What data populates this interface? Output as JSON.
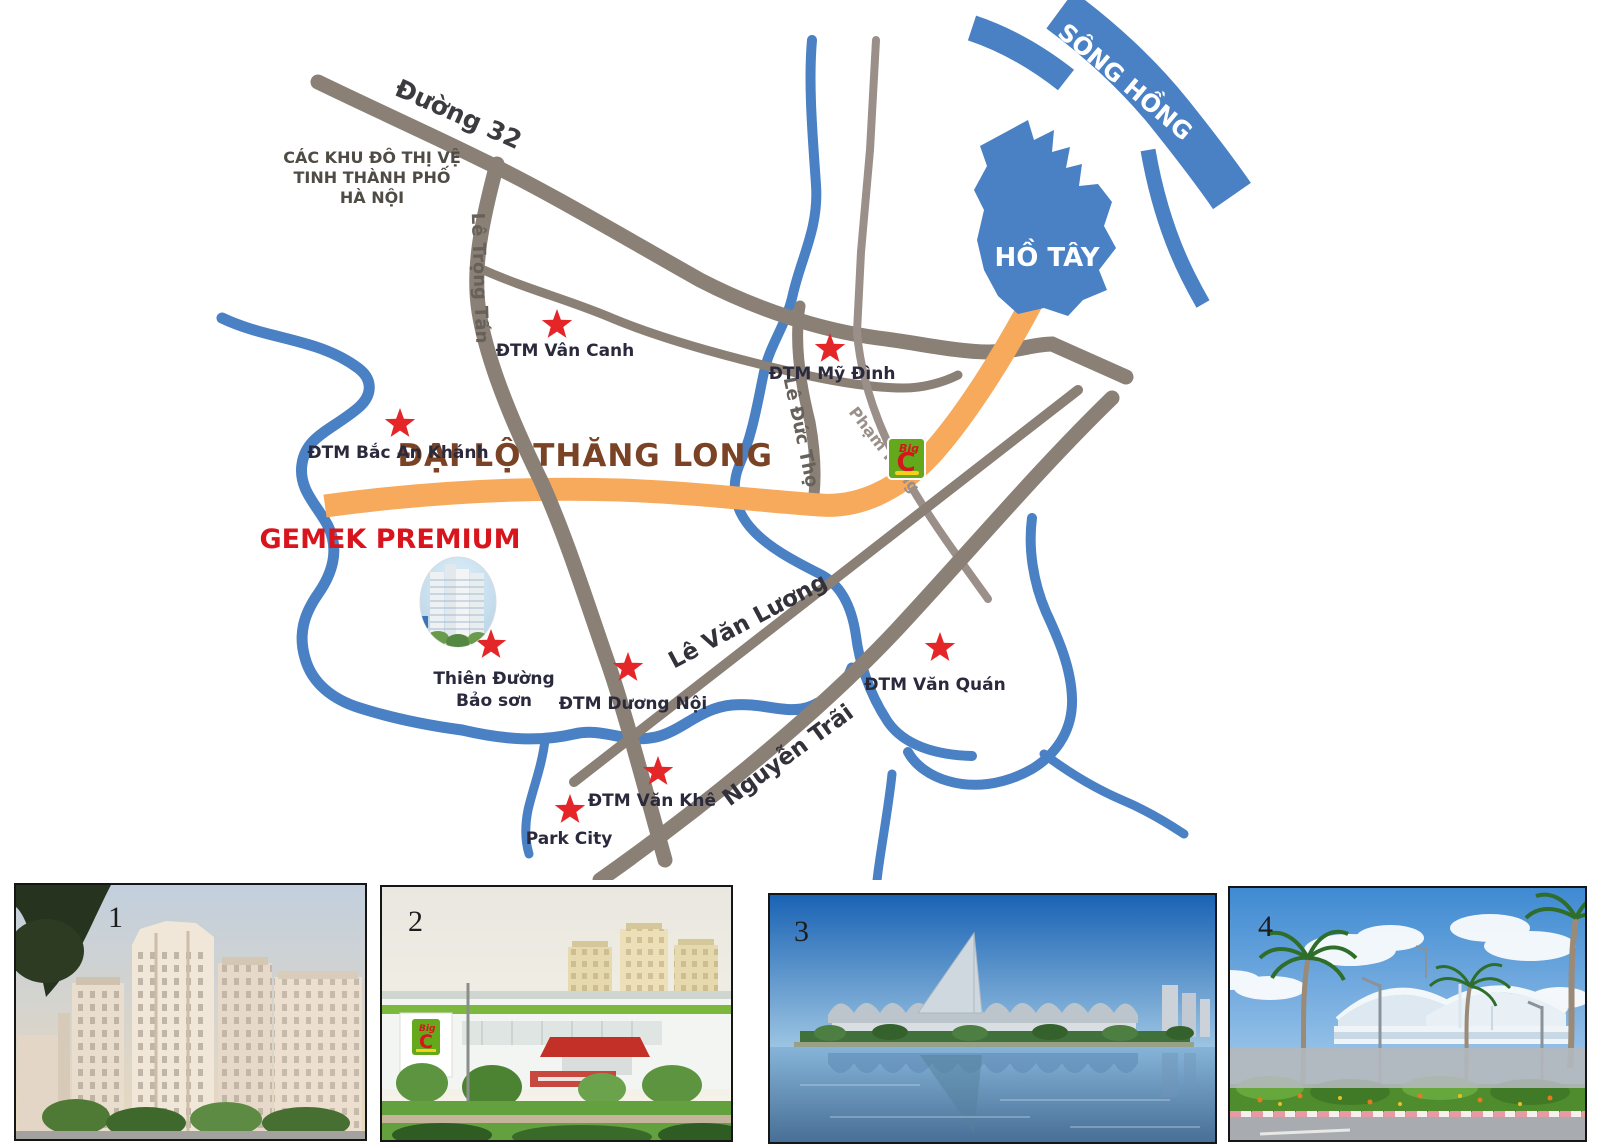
{
  "colors": {
    "water": "#4a80c4",
    "road": "#8a8076",
    "road_light": "#9a9089",
    "highway": "#f7a95c",
    "star": "#e52629",
    "landmark_label": "#2b2a3d",
    "highway_label": "#7b4326",
    "project_red": "#d8141c",
    "water_label": "#ffffff"
  },
  "map": {
    "note": {
      "lines": [
        "CÁC KHU ĐÔ THỊ VỆ",
        "TINH THÀNH PHỐ",
        "HÀ NỘI"
      ]
    },
    "roads": {
      "duong_32": "Đường 32",
      "le_trong_tan": "Lê Trọng Tấn",
      "le_duc_tho": "Lê Đức Thọ",
      "pham_hung": "Phạm Hùng",
      "le_van_luong": "Lê Văn Lương",
      "nguyen_trai": "Nguyễn Trãi",
      "dai_lo_thang_long": "ĐẠI LỘ THĂNG LONG"
    },
    "water": {
      "song_hong": "SÔNG HỒNG",
      "ho_tay": "HỒ TÂY"
    },
    "project": {
      "name": "GEMEK PREMIUM"
    },
    "landmarks": [
      {
        "label": "ĐTM Vân Canh"
      },
      {
        "label": "ĐTM Mỹ Đình"
      },
      {
        "label": "ĐTM Bắc An Khánh"
      },
      {
        "label": "Thiên Đường",
        "label2": "Bảo sơn"
      },
      {
        "label": "ĐTM Dương Nội"
      },
      {
        "label": "ĐTM Văn Quán"
      },
      {
        "label": "ĐTM Văn Khê"
      },
      {
        "label": "Park City"
      }
    ],
    "bigc": {
      "word": "Big",
      "letter": "C"
    }
  },
  "photos": [
    {
      "number": "1"
    },
    {
      "number": "2"
    },
    {
      "number": "3"
    },
    {
      "number": "4"
    }
  ]
}
